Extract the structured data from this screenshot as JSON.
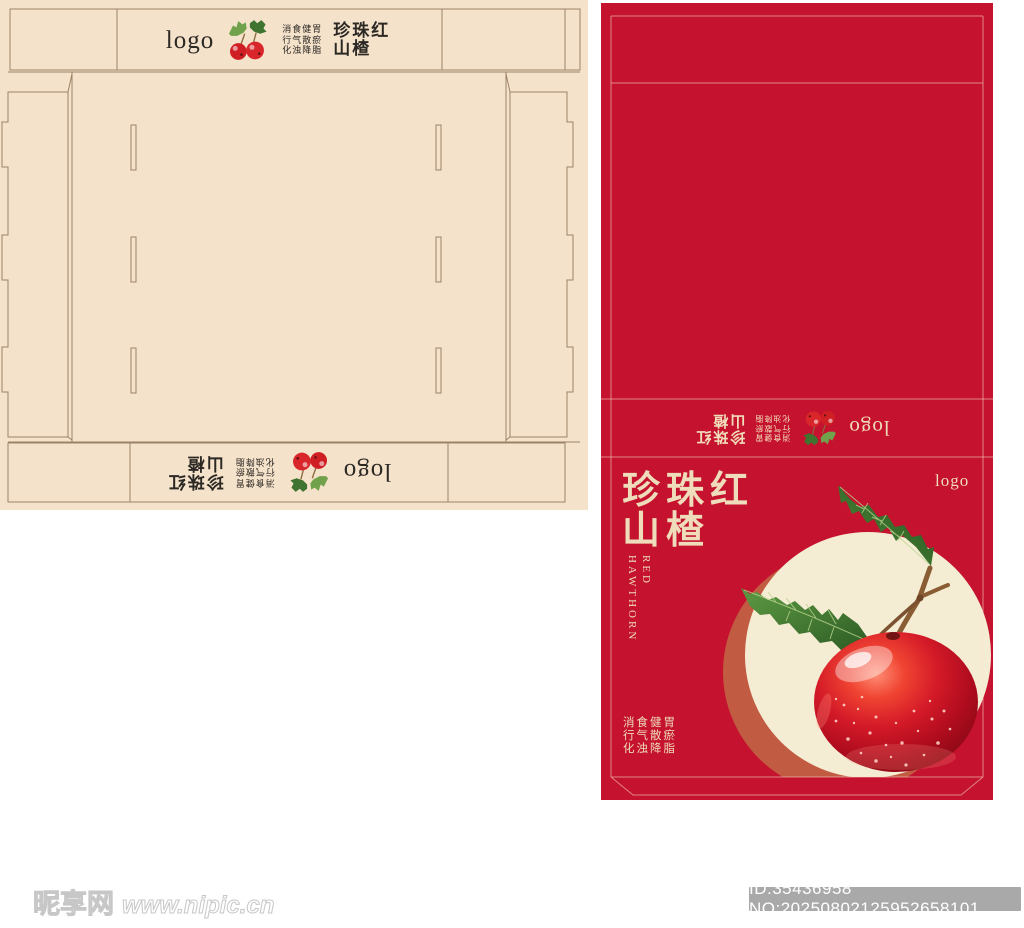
{
  "package": {
    "logo": "logo",
    "title_cn": [
      "珍珠红",
      "山楂"
    ],
    "title_en": [
      "RED",
      "HAWTHORN"
    ],
    "benefits": [
      "消食健胃",
      "行气散瘀",
      "化浊降脂"
    ],
    "colors": {
      "package_red": "#c5122e",
      "sheet_cream": "#f4e2ca",
      "cream_text": "#eedcba",
      "terracotta_circle": "#c15b41",
      "cream_circle": "#f5ecd4",
      "dieline_stroke": "#9c8166"
    },
    "icons": {
      "berries": "hawthorn-berries-icon",
      "fruit": "hawthorn-fruit-illustration"
    }
  },
  "watermark": {
    "site_name": "昵享网",
    "site_url": "www.nipic.cn",
    "id_label": "ID:35436958 NO:20250802125952658101"
  }
}
